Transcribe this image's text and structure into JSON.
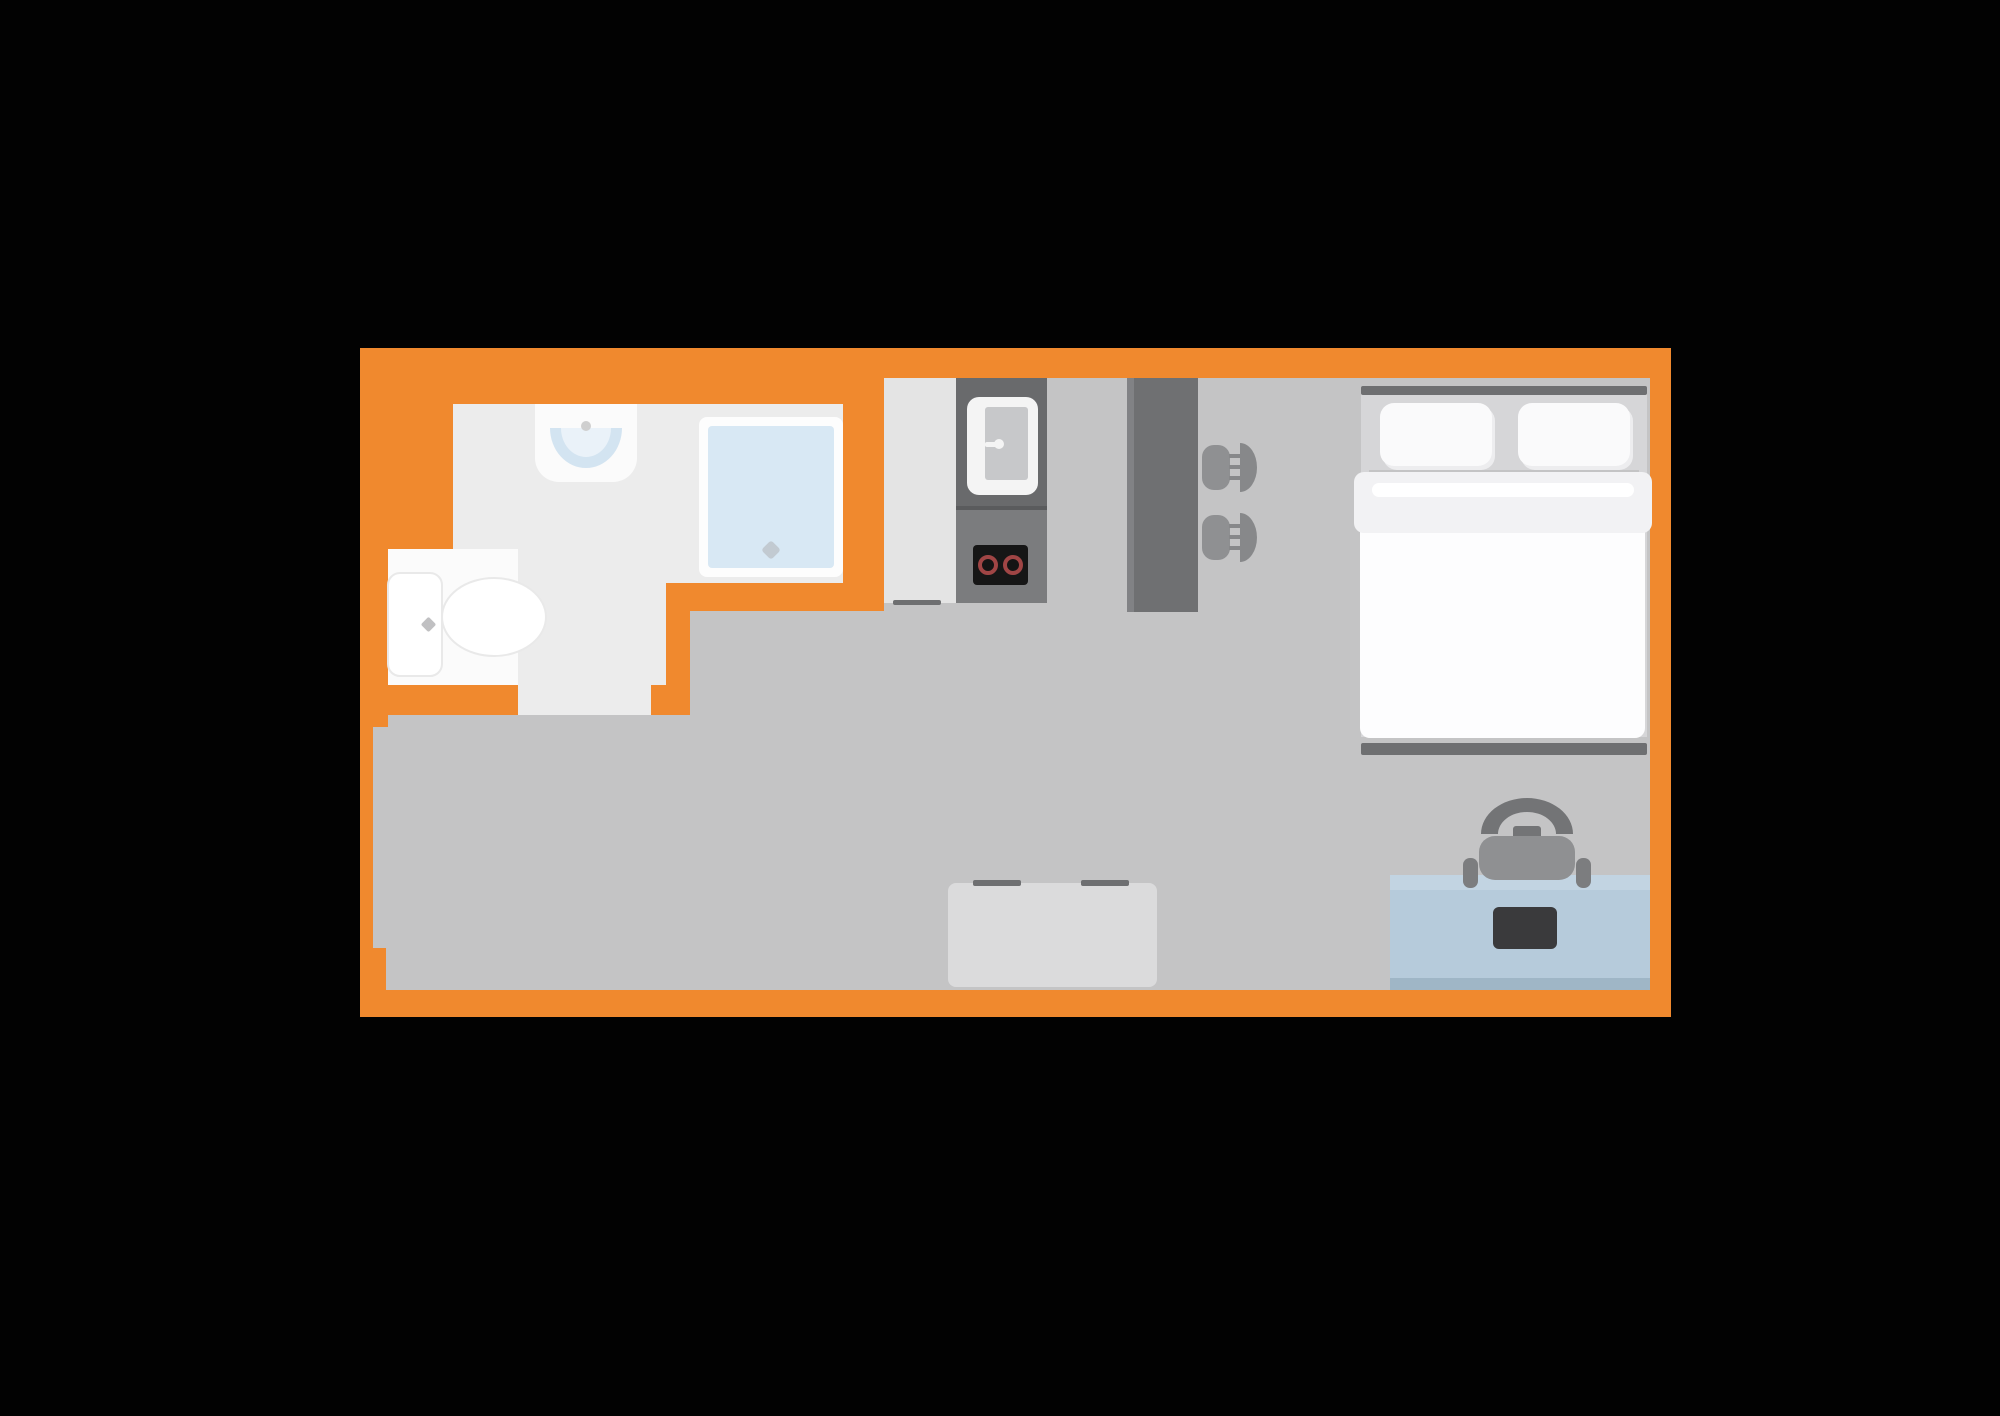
{
  "scene": {
    "type": "studio-apartment-floor-plan",
    "rooms": [
      {
        "name": "bathroom"
      },
      {
        "name": "kitchen"
      },
      {
        "name": "living-sleeping-area"
      }
    ],
    "fixtures": [
      "bathroom-sink",
      "shower",
      "toilet",
      "kitchen-sink-unit",
      "stove-two-burners",
      "breakfast-counter",
      "bar-stool",
      "bar-stool",
      "double-bed",
      "pillow",
      "pillow",
      "table",
      "desk",
      "office-chair",
      "laptop"
    ],
    "door_openings": [
      "bathroom-door-bottom-wall",
      "entry-opening-left-wall"
    ]
  },
  "colors": {
    "background": "#020202",
    "wall": "#F0892E",
    "floor": "#C4C4C5",
    "kitchen_floor": "#E4E4E4",
    "bathroom_floor": "#ECECEC",
    "toilet_alcove": "#FBFBFB",
    "fixture_white": "#FBFBFB",
    "shower_rim": "#FDFDFD",
    "shower_glass": "#D8E8F4",
    "drain": "#C2CAD1",
    "sink_bowl": "#D3E4F1",
    "sink_bowl_light": "#EAF2F9",
    "faucet_gray": "#CFCFCF",
    "toilet_white": "#FFFFFF",
    "toilet_outline": "#E9E9E9",
    "toilet_button": "#C0C0C2",
    "unit_dark": "#696A6C",
    "unit_light": "#7B7C7E",
    "unit_divider": "#5A5B5D",
    "basin_rim": "#F4F4F4",
    "basin_inner": "#C7C8CA",
    "stove_black": "#161616",
    "burner_center": "#141414",
    "burner_ring": "#A04545",
    "counter": "#6F7072",
    "counter_edge": "#818285",
    "stool_seat": "#8F9092",
    "stool_back": "#87888A",
    "dark_bar": "#6E6F71",
    "bed_frame": "#D6D6D8",
    "pillow": "#FAFAFB",
    "pillow_shade": "#EDEDEF",
    "duvet": "#FDFDFE",
    "fold_band": "#F2F2F4",
    "fold_highlight": "#FFFFFF",
    "desk": "#B6CBDB",
    "desk_top": "#C2D4E2",
    "desk_edge": "#9FB6C6",
    "laptop": "#3A3A3C",
    "chair_back": "#737476",
    "chair_seat": "#8F9092",
    "chair_arm": "#7C7D7F",
    "table": "#DBDBDC"
  }
}
